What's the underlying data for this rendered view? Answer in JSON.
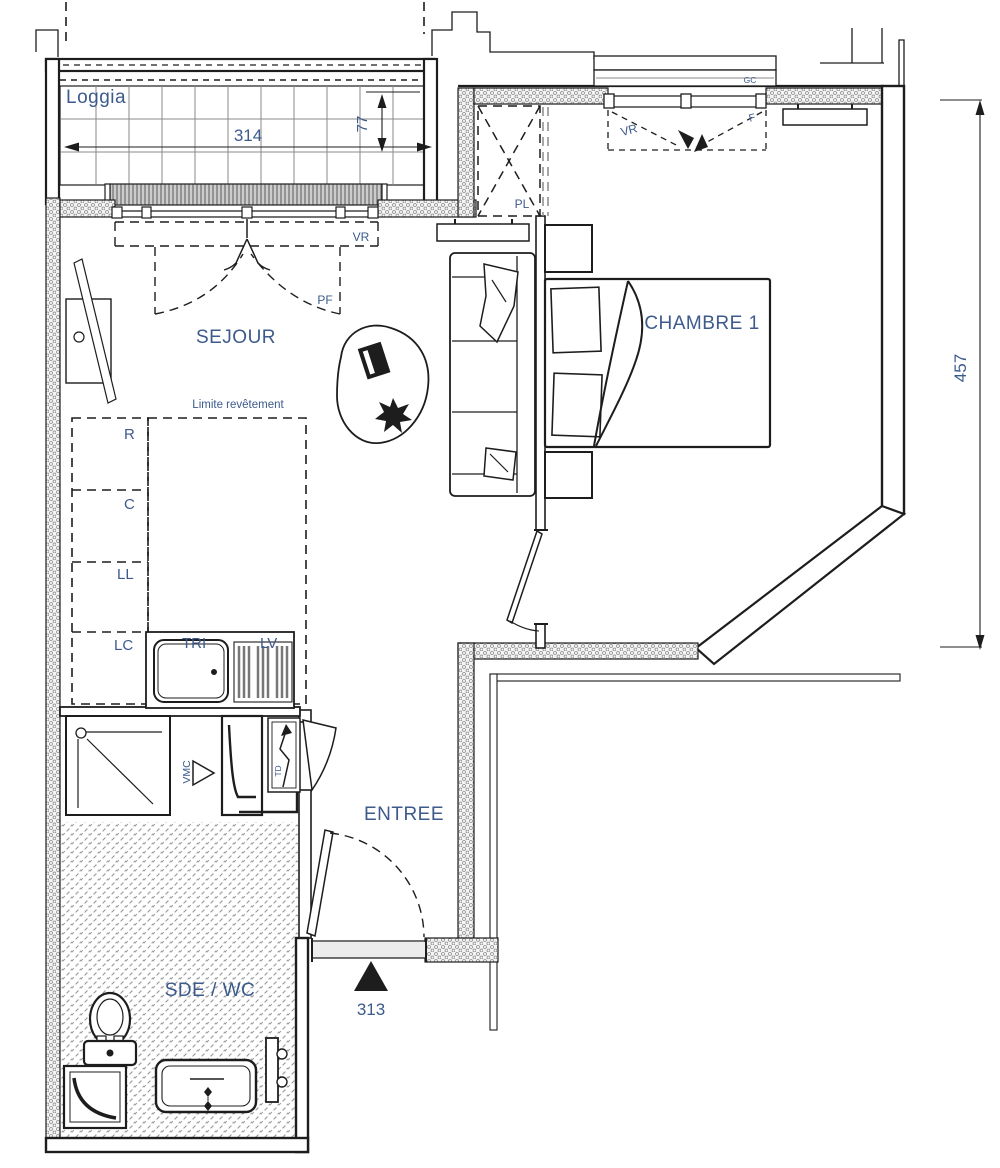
{
  "rooms": {
    "loggia": "Loggia",
    "living": "SEJOUR",
    "bedroom": "CHAMBRE 1",
    "entry": "ENTREE",
    "bathroom": "SDE / WC"
  },
  "dimensions": {
    "loggia_width": "314",
    "loggia_depth": "77",
    "right_side_height": "457",
    "entry_door_ref": "313"
  },
  "annotations": {
    "shutter_living": "VR",
    "french_door": "PF",
    "closet": "PL",
    "shutter_bedroom": "VR",
    "window": "F",
    "gc": "GC",
    "vent": "VMC",
    "panel": "TD",
    "finish_limit": "Limite revêtement"
  },
  "kitchen_units": {
    "r": "R",
    "c": "C",
    "ll": "LL",
    "lc": "LC",
    "tri": "TRI",
    "lv": "LV"
  },
  "colors": {
    "label_blue": "#3c5a8c",
    "line_black": "#1d1d1d",
    "wall_hatch_grey": "#8f8f8f"
  }
}
